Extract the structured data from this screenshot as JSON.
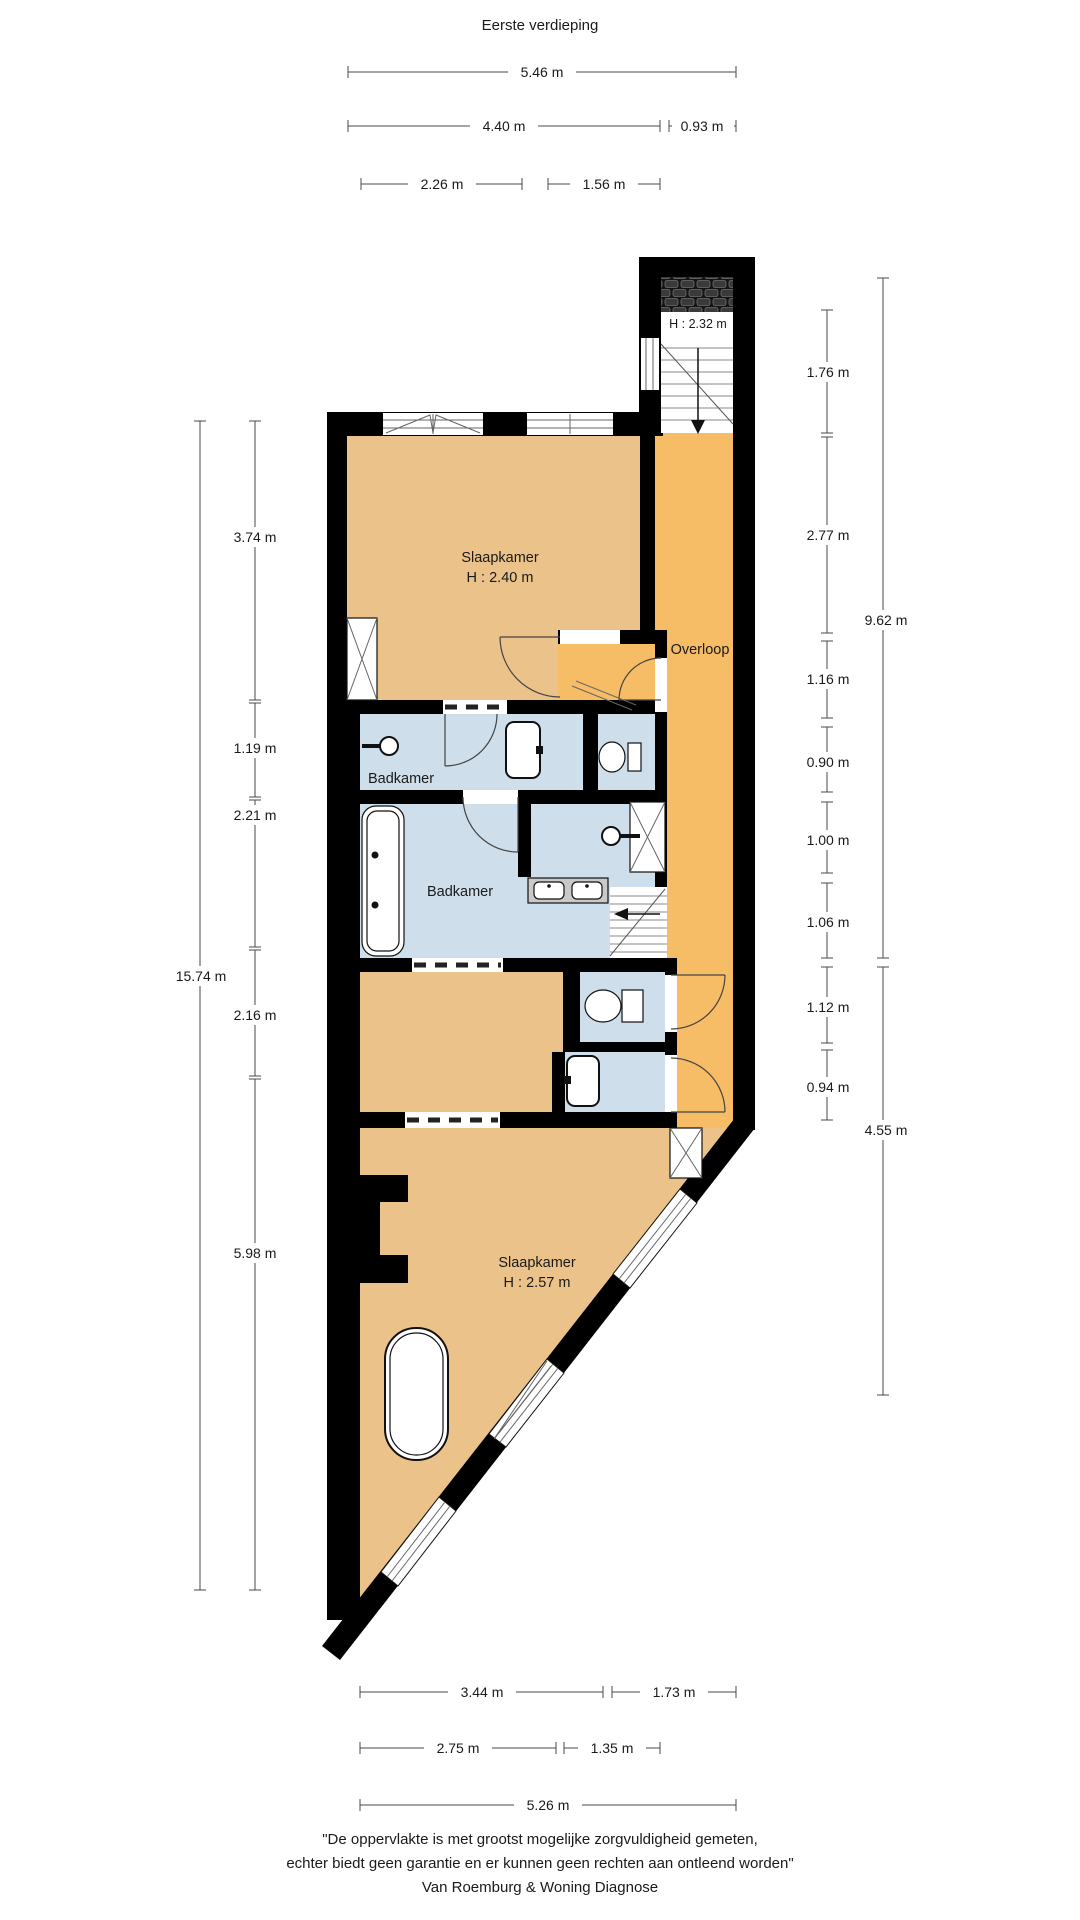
{
  "title": "Eerste verdieping",
  "rooms": {
    "bedroom_top": {
      "name": "Slaapkamer",
      "height": "H : 2.40 m"
    },
    "bedroom_bottom": {
      "name": "Slaapkamer",
      "height": "H : 2.57 m"
    },
    "bathroom_small": {
      "name": "Badkamer"
    },
    "bathroom_large": {
      "name": "Badkamer"
    },
    "landing": {
      "name": "Overloop"
    },
    "stairwell": {
      "height": "H : 2.32 m"
    }
  },
  "dimensions": {
    "top": [
      "5.46 m",
      "4.40 m",
      "0.93 m",
      "2.26 m",
      "1.56 m"
    ],
    "bottom": [
      "3.44 m",
      "1.73 m",
      "2.75 m",
      "1.35 m",
      "5.26 m"
    ],
    "left": [
      "3.74 m",
      "1.19 m",
      "2.21 m",
      "2.16 m",
      "5.98 m",
      "15.74 m"
    ],
    "right": [
      "1.76 m",
      "2.77 m",
      "1.16 m",
      "0.90 m",
      "1.00 m",
      "1.06 m",
      "1.12 m",
      "0.94 m",
      "9.62 m",
      "4.55 m"
    ]
  },
  "footer": {
    "line1": "\"De oppervlakte is met grootst mogelijke zorgvuldigheid gemeten,",
    "line2": "echter biedt geen garantie en er kunnen geen rechten aan ontleend worden\"",
    "line3": "Van Roemburg & Woning Diagnose"
  },
  "colors": {
    "floor": "#ebc289",
    "landing": "#f6bc66",
    "wet_room": "#cfdeeb",
    "wall": "#000000",
    "counter": "#c9c9c9"
  }
}
